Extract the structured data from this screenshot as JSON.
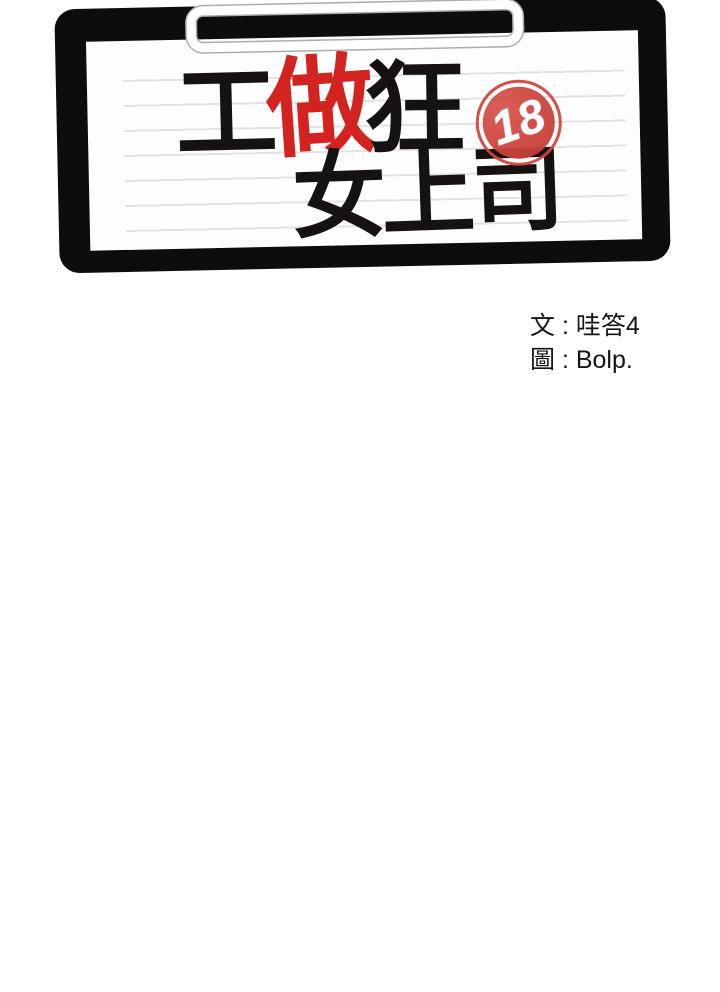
{
  "title": {
    "full_title": "工做狂女上司",
    "line1_chars": [
      {
        "char": "工",
        "color": "#171212"
      },
      {
        "char": "做",
        "color": "#d32320"
      },
      {
        "char": "狂",
        "color": "#171212"
      }
    ],
    "line2": "女上司"
  },
  "badge": {
    "text": "18",
    "color": "#d0463f"
  },
  "credits": {
    "writer": "文 : 哇答4",
    "artist": "圖 : Bolp."
  },
  "colors": {
    "page_background": "#ffffff",
    "frame_black": "#0f0c0c",
    "paper_white": "#fefdfd",
    "ruled_line_gray": "#e4e3e2",
    "accent_red": "#d32320",
    "stamp_red": "#d0463f",
    "clip_gray": "#adadad"
  }
}
